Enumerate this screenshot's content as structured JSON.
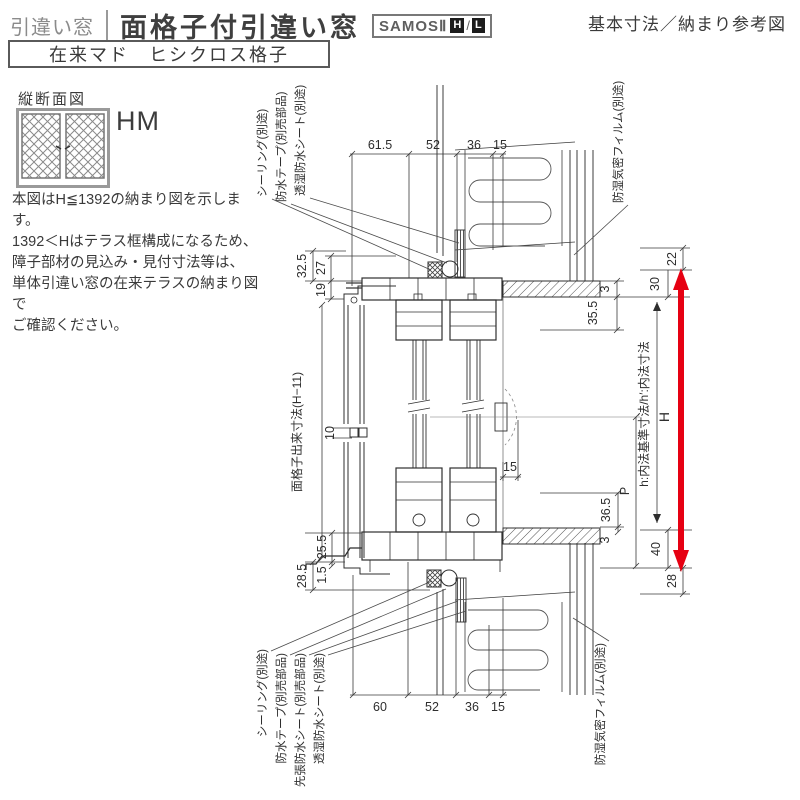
{
  "header": {
    "category": "引違い窓",
    "title": "面格子付引違い窓",
    "badge": {
      "series": "SAMOSⅡ",
      "h": "H",
      "slash": "/",
      "l": "L"
    },
    "right_title": "基本寸法／納まり参考図",
    "subtitle_box": "在来マド　ヒシクロス格子"
  },
  "left_panel": {
    "section_label": "縦断面図",
    "icon_label": "HM",
    "notes": {
      "line1": "本図はH≦1392の納まり図を示します。",
      "line2": "1392＜Hはテラス框構成になるため、",
      "line3": "障子部材の見込み・見付寸法等は、",
      "line4": "単体引違い窓の在来テラスの納まり図で",
      "line5": "ご確認ください。"
    }
  },
  "drawing": {
    "callouts": {
      "top": [
        "シーリング(別途)",
        "防水テープ(別売部品)",
        "透湿防水シート(別途)"
      ],
      "top_right": "防湿気密フィルム(別途)",
      "bottom": [
        "シーリング(別途)",
        "防水テープ(別売部品)",
        "先張防水シート(別売部品)",
        "透湿防水シート(別途)"
      ],
      "bottom_right": "防湿気密フィルム(別途)"
    },
    "dims": {
      "top": [
        "61.5",
        "52",
        "36",
        "15"
      ],
      "bottom": [
        "60",
        "52",
        "36",
        "15"
      ],
      "left_head": [
        "32.5",
        "27",
        "19"
      ],
      "left_sill": [
        "25.5",
        "1.5",
        "28.5"
      ],
      "right_head": [
        "22",
        "30",
        "3",
        "35.5"
      ],
      "right_sill": [
        "36.5",
        "3",
        "40",
        "28"
      ],
      "lattice_pitch": "10",
      "clearance": "15",
      "height_total": "H",
      "handle_height": "P"
    },
    "axis_labels": {
      "lattice": "面格子出来寸法(H−11)",
      "inner": "h:内法基準寸法/h′:内法寸法"
    },
    "colors": {
      "arrow": "#e60012"
    }
  }
}
